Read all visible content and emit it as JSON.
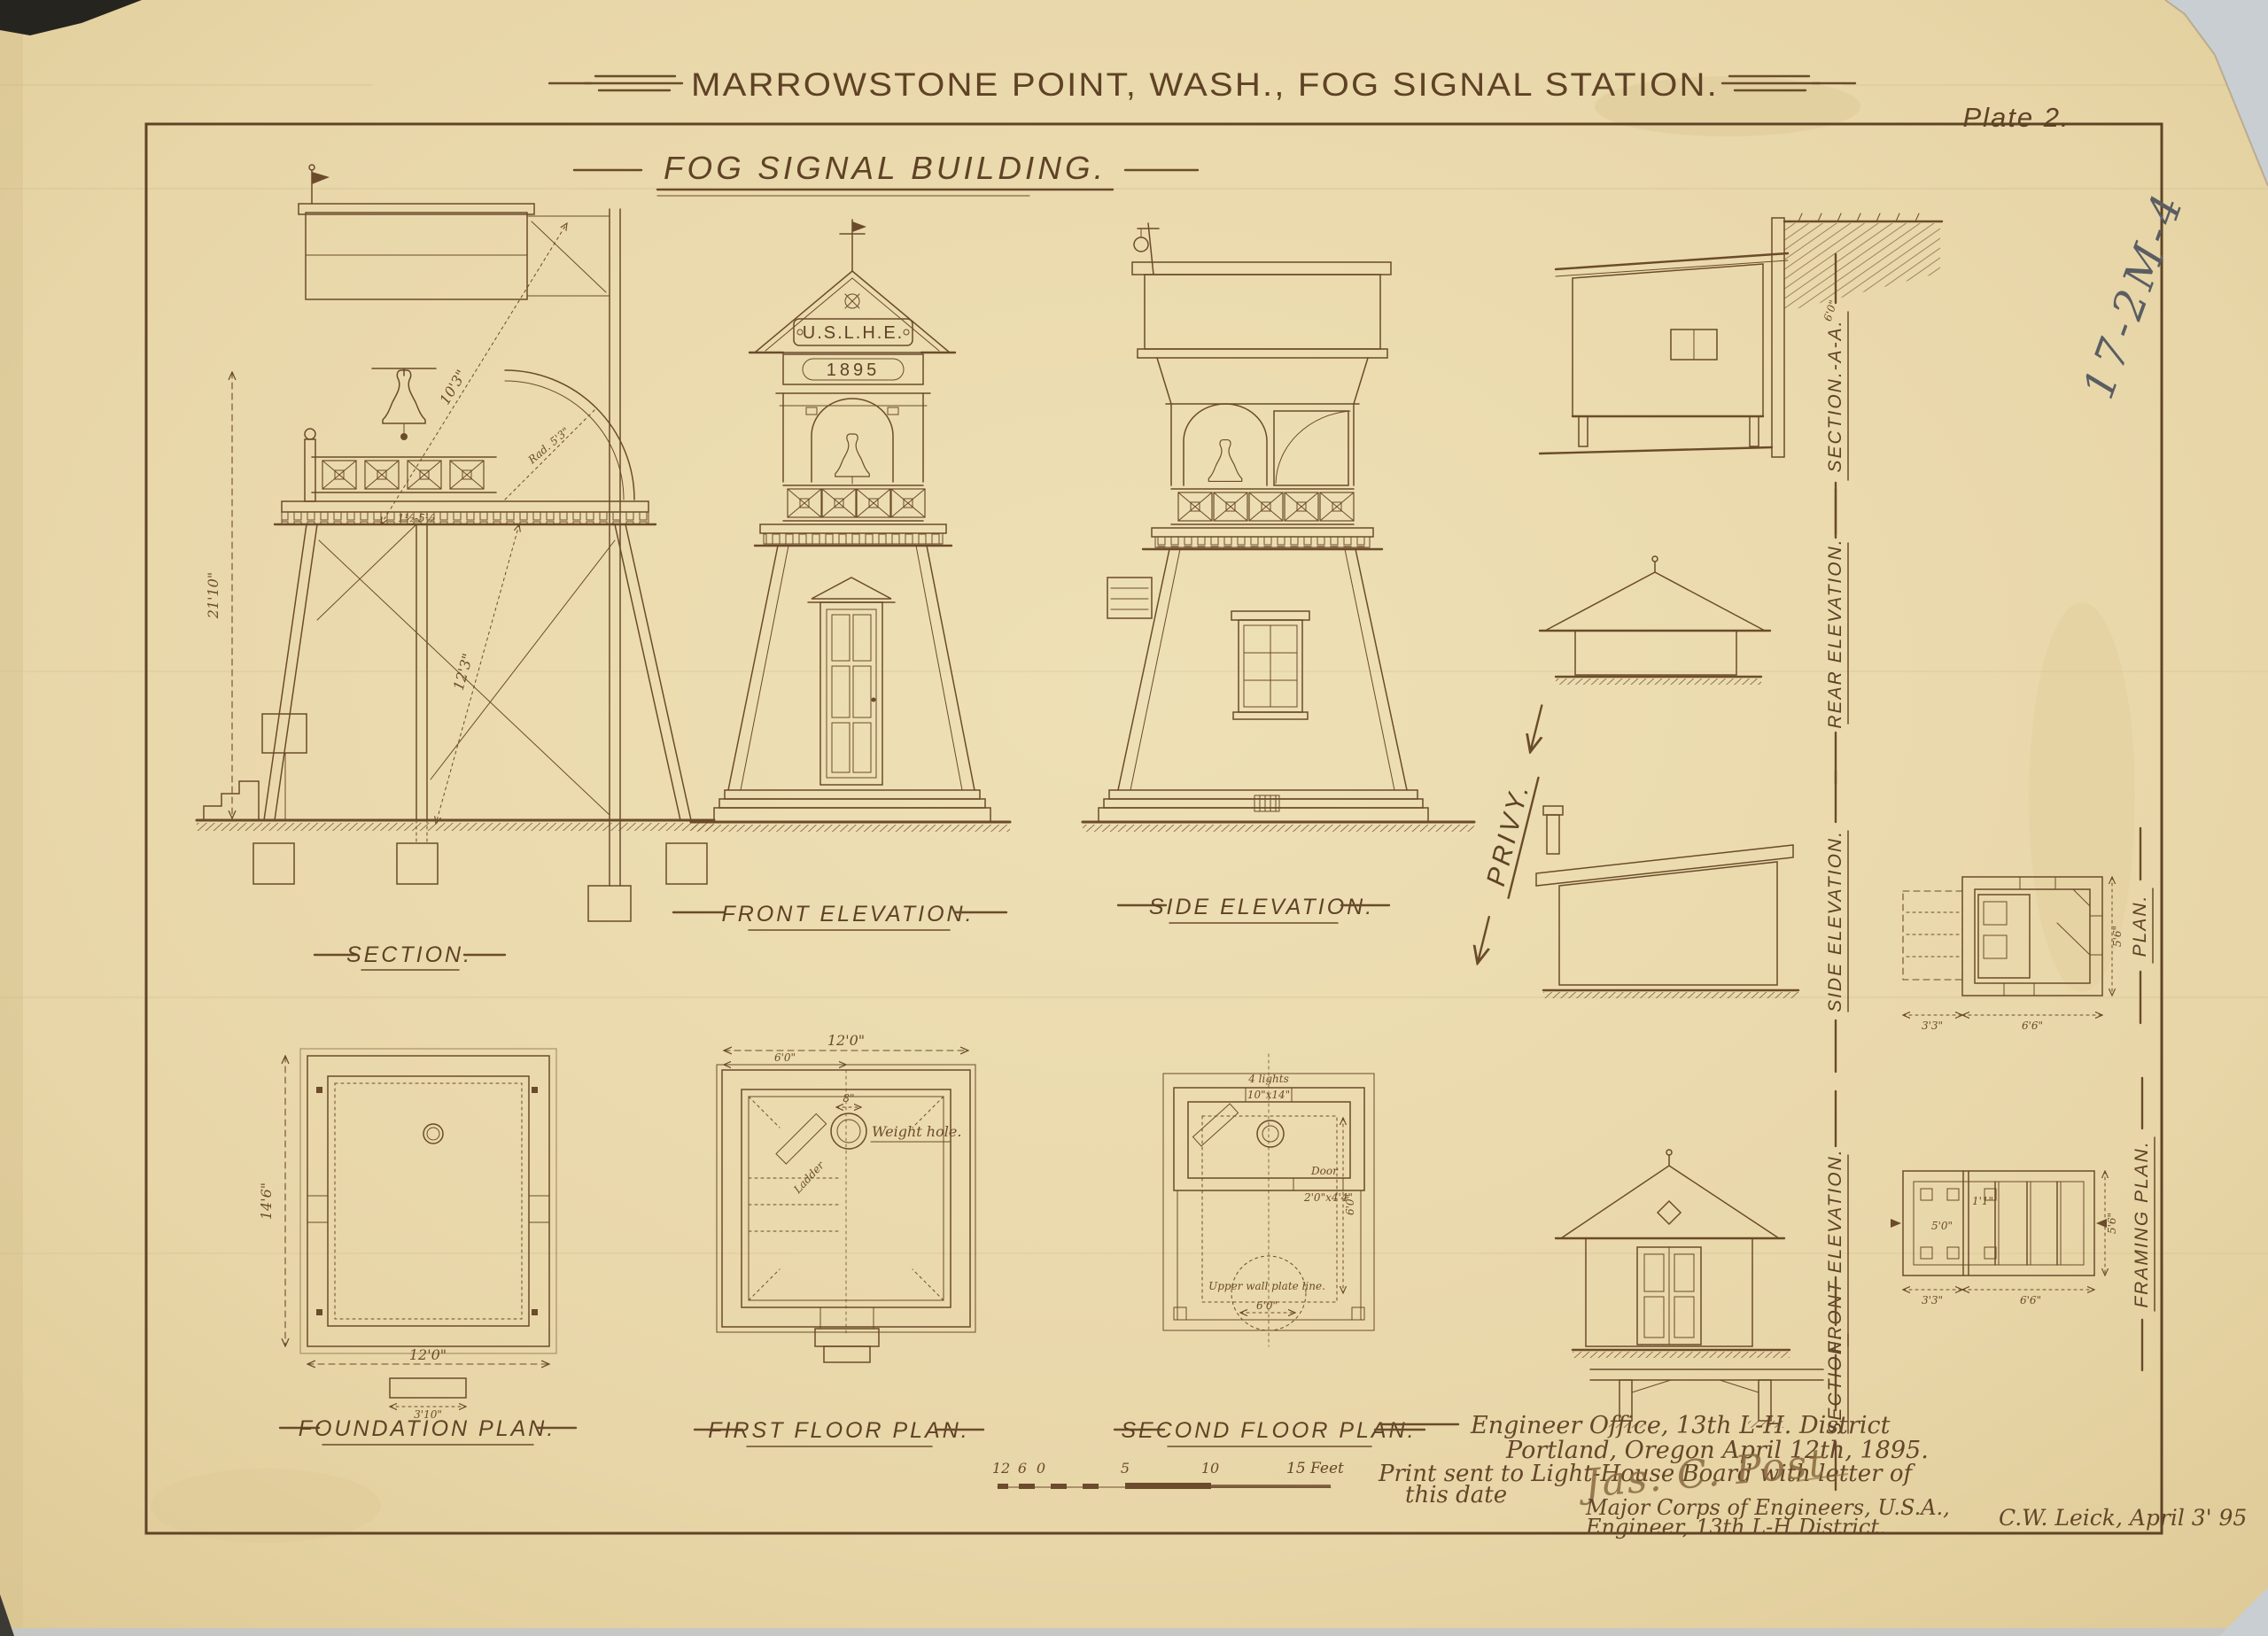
{
  "sheet": {
    "title": "MARROWSTONE POINT, WASH., FOG SIGNAL STATION.",
    "plate": "Plate 2.",
    "subtitle": "FOG SIGNAL BUILDING.",
    "file_number": "17-2M-4",
    "ink_color": "#6b4b2b",
    "paper_color": "#e8d7aa"
  },
  "labels": {
    "section": "SECTION.",
    "front_elevation": "FRONT ELEVATION.",
    "side_elevation": "SIDE ELEVATION.",
    "privy": "PRIVY.",
    "privy_section_aa": "SECTION.-A-A.",
    "privy_rear_elevation": "REAR ELEVATION.",
    "privy_side_elevation": "SIDE ELEVATION.",
    "privy_plan": "PLAN.",
    "privy_front_elevation": "FRONT ELEVATION.",
    "privy_framing_plan": "FRAMING PLAN.",
    "privy_section": "SECTION.",
    "foundation_plan": "FOUNDATION PLAN.",
    "first_floor_plan": "FIRST FLOOR PLAN.",
    "second_floor_plan": "SECOND FLOOR PLAN."
  },
  "tower": {
    "plaque": "U.S.L.H.E.",
    "year": "1895"
  },
  "dims": {
    "section_height": "21'10\"",
    "section_upper": "10'3\"",
    "section_lower": "12'3\"",
    "section_radius": "Rad. 5'3\"",
    "section_brace": "1½-5½",
    "foundation_height": "14'6\"",
    "foundation_width": "12'0\"",
    "foundation_step": "3'10\"",
    "first_floor_width": "12'0\"",
    "first_floor_half": "6'0\"",
    "weight_hole_dia": "8\"",
    "privy_porch": "3'3\"",
    "privy_body": "6'6\"",
    "privy_depth": "5'6\"",
    "framing_span": "5'0\"",
    "framing_joist": "1'1\"",
    "privy_height": "6'0\"",
    "second_floor_dim": "6'0\""
  },
  "annotations": {
    "weight_hole": "Weight hole.",
    "ladder": "Ladder",
    "lights_1": "4 lights",
    "lights_2": "10\"x14\"",
    "door_1": "Door",
    "door_2": "2'0\"x4'4\"",
    "plate_line": "Upper wall plate line.",
    "plate_dim": "6'0\""
  },
  "scale_bar": {
    "marks": [
      "12",
      "6",
      "0",
      "5",
      "10"
    ],
    "end_label": "15 Feet"
  },
  "title_block": {
    "line1": "Engineer Office, 13th L-H. District",
    "line2": "Portland, Oregon April 12th, 1895.",
    "line3": "Print sent to Light-House Board with letter of",
    "line4": "this date",
    "signature": "Jas. C. Post",
    "line5": "Major Corps of Engineers, U.S.A.,",
    "line6": "Engineer, 13th L-H District."
  },
  "footer": {
    "drafter": "C.W. Leick, April 3' 95"
  }
}
